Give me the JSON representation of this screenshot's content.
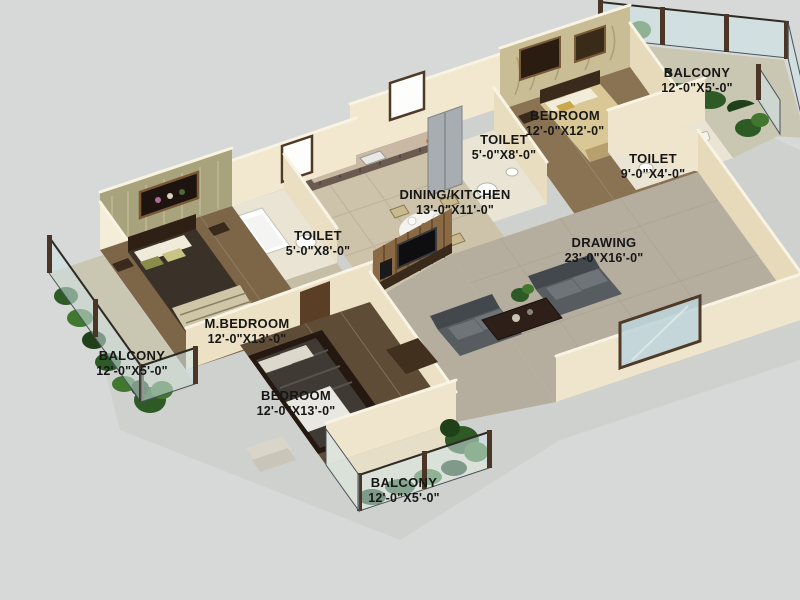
{
  "scene": {
    "background": "#d6d9d7",
    "wall_color": "#efe5cc",
    "wallpaper_sage": "#a8a27d",
    "wallpaper_floral": "#c9bd96",
    "glass_color": "#cfe3e8",
    "plant_dark": "#1f4019",
    "plant_mid": "#2e5a26",
    "plant_light": "#41772f",
    "wood_floor": "#7d6548",
    "sofa_gray": "#565c5f"
  },
  "rooms": [
    {
      "id": "balcony-top-right",
      "name": "BALCONY",
      "dims": "12'-0\"X5'-0\""
    },
    {
      "id": "bedroom-top",
      "name": "BEDROOM",
      "dims": "12'-0\"X12'-0\""
    },
    {
      "id": "toilet-top",
      "name": "TOILET",
      "dims": "5'-0\"X8'-0\""
    },
    {
      "id": "toilet-right",
      "name": "TOILET",
      "dims": "9'-0\"X4'-0\""
    },
    {
      "id": "dining-kitchen",
      "name": "DINING/KITCHEN",
      "dims": "13'-0\"X11'-0\""
    },
    {
      "id": "toilet-left",
      "name": "TOILET",
      "dims": "5'-0\"X8'-0\""
    },
    {
      "id": "drawing",
      "name": "DRAWING",
      "dims": "23'-0\"X16'-0\""
    },
    {
      "id": "m-bedroom",
      "name": "M.BEDROOM",
      "dims": "12'-0\"X13'-0\""
    },
    {
      "id": "balcony-left",
      "name": "BALCONY",
      "dims": "12'-0\"X5'-0\""
    },
    {
      "id": "bedroom-bottom",
      "name": "BEDROOM",
      "dims": "12'-0\"X13'-0\""
    },
    {
      "id": "balcony-bottom",
      "name": "BALCONY",
      "dims": "12'-0\"X5'-0\""
    }
  ]
}
